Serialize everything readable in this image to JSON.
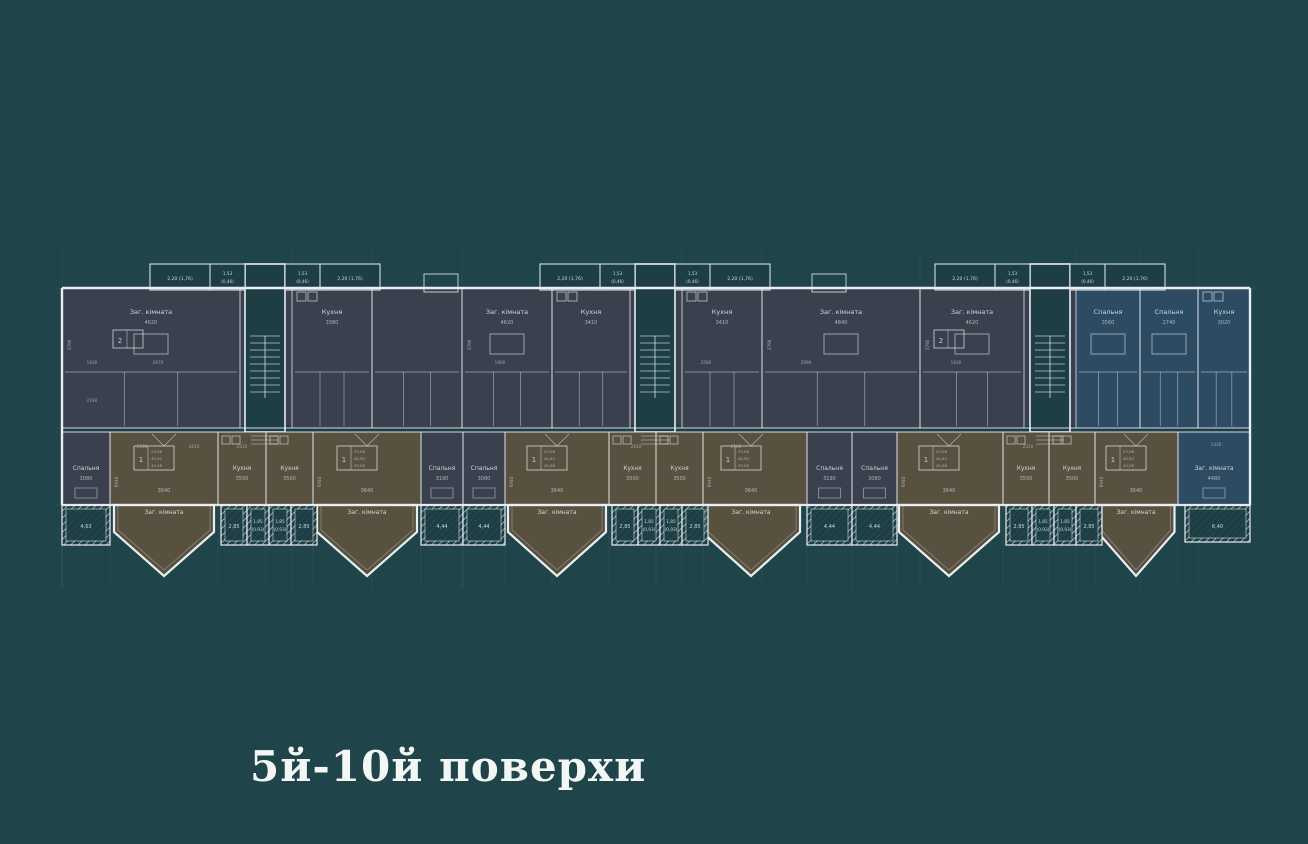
{
  "title": "5й-10й поверхи",
  "colors": {
    "background": "#1f4449",
    "room_dark": "#3a404d",
    "room_brown": "#595140",
    "room_blue": "#2d4b63",
    "core_fill": "#1c3e44",
    "wall": "#e9eef1",
    "label": "#ccd6da",
    "dim": "#a9b6bd",
    "title_color": "#f2f6f5"
  },
  "plan": {
    "balcony_top_large": "2,20 (1,76)",
    "balcony_top_small": "1,53 (0,46)",
    "cores": [
      {
        "cx": 265
      },
      {
        "cx": 655
      },
      {
        "cx": 1050
      }
    ],
    "upper_rooms": [
      {
        "x": 62,
        "w": 178,
        "label": "Заг. кімната",
        "dim": "4620",
        "fill": "dark",
        "badge": "2",
        "vdim": "3790"
      },
      {
        "x": 292,
        "w": 80,
        "label": "Кухня",
        "dim": "3380",
        "fill": "dark"
      },
      {
        "x": 372,
        "w": 90,
        "label": "",
        "dim": "",
        "fill": "dark"
      },
      {
        "x": 462,
        "w": 90,
        "label": "Заг. кімната",
        "dim": "4620",
        "fill": "dark",
        "vdim": "3790"
      },
      {
        "x": 552,
        "w": 78,
        "label": "Кухня",
        "dim": "3410",
        "fill": "dark"
      },
      {
        "x": 682,
        "w": 80,
        "label": "Кухня",
        "dim": "3410",
        "fill": "dark"
      },
      {
        "x": 762,
        "w": 158,
        "label": "Заг. кімната",
        "dim": "4840",
        "fill": "dark",
        "vdim": "3790"
      },
      {
        "x": 920,
        "w": 104,
        "label": "Заг. кімната",
        "dim": "4620",
        "fill": "dark",
        "badge": "2",
        "vdim": "3790"
      },
      {
        "x": 1076,
        "w": 64,
        "label": "Спальня",
        "dim": "3560",
        "fill": "blue"
      },
      {
        "x": 1140,
        "w": 58,
        "label": "Спальня",
        "dim": "2740",
        "fill": "blue"
      },
      {
        "x": 1198,
        "w": 52,
        "label": "Кухня",
        "dim": "3020",
        "fill": "blue"
      }
    ],
    "lower_rooms": [
      {
        "type": "spalnya",
        "x": 62,
        "w": 48,
        "label": "Спальня",
        "dim": "3080"
      },
      {
        "type": "living",
        "x": 110,
        "w": 108,
        "bay": 164,
        "label": "Заг. кімната",
        "dim": "3640",
        "vdim": "6940"
      },
      {
        "type": "kitchen",
        "x": 218,
        "w": 48,
        "label": "Кухня",
        "dim": "3500"
      },
      {
        "type": "kitchen",
        "x": 266,
        "w": 47,
        "label": "Кухня",
        "dim": "3500"
      },
      {
        "type": "living",
        "x": 313,
        "w": 108,
        "bay": 367,
        "label": "Заг. кімната",
        "dim": "3640",
        "vdim": "6940"
      },
      {
        "type": "spalnya",
        "x": 421,
        "w": 42,
        "label": "Спальня",
        "dim": "3190"
      },
      {
        "type": "spalnya",
        "x": 463,
        "w": 42,
        "label": "Спальня",
        "dim": "3080"
      },
      {
        "type": "living",
        "x": 505,
        "w": 104,
        "bay": 557,
        "label": "Заг. кімната",
        "dim": "3640",
        "vdim": "6940"
      },
      {
        "type": "kitchen",
        "x": 609,
        "w": 47,
        "label": "Кухня",
        "dim": "3500"
      },
      {
        "type": "kitchen",
        "x": 656,
        "w": 47,
        "label": "Кухня",
        "dim": "3500"
      },
      {
        "type": "living",
        "x": 703,
        "w": 104,
        "bay": 751,
        "label": "Заг. кімната",
        "dim": "3640",
        "vdim": "6940"
      },
      {
        "type": "spalnya",
        "x": 807,
        "w": 45,
        "label": "Спальня",
        "dim": "3190"
      },
      {
        "type": "spalnya",
        "x": 852,
        "w": 45,
        "label": "Спальня",
        "dim": "3080"
      },
      {
        "type": "living",
        "x": 897,
        "w": 106,
        "bay": 949,
        "label": "Заг. кімната",
        "dim": "3640",
        "vdim": "6940"
      },
      {
        "type": "kitchen",
        "x": 1003,
        "w": 46,
        "label": "Кухня",
        "dim": "3500"
      },
      {
        "type": "kitchen",
        "x": 1049,
        "w": 46,
        "label": "Кухня",
        "dim": "3500"
      },
      {
        "type": "living",
        "x": 1095,
        "w": 83,
        "bay": 1136,
        "label": "Заг. кімната",
        "dim": "3640",
        "vdim": "6940"
      },
      {
        "type": "blue_living",
        "x": 1178,
        "w": 72,
        "label": "Заг. кімната",
        "dim": "4480"
      }
    ],
    "badge1": {
      "num": "1",
      "values": [
        "23,06",
        "40,50",
        "43,28"
      ]
    },
    "badge2": {
      "num": "2",
      "values": []
    },
    "bottom_balconies": [
      {
        "x": 62,
        "w": 48,
        "label": "4,63"
      },
      {
        "x": 221,
        "w": 26,
        "label": "2,85"
      },
      {
        "x": 247,
        "w": 22,
        "label": "1,85 (0,93)"
      },
      {
        "x": 269,
        "w": 22,
        "label": "1,85 (0,93)"
      },
      {
        "x": 291,
        "w": 26,
        "label": "2,85"
      },
      {
        "x": 421,
        "w": 42,
        "label": "4,44"
      },
      {
        "x": 463,
        "w": 42,
        "label": "4,44"
      },
      {
        "x": 612,
        "w": 26,
        "label": "2,85"
      },
      {
        "x": 638,
        "w": 22,
        "label": "1,85 (0,93)"
      },
      {
        "x": 660,
        "w": 22,
        "label": "1,85 (0,93)"
      },
      {
        "x": 682,
        "w": 26,
        "label": "2,85"
      },
      {
        "x": 807,
        "w": 45,
        "label": "4,44"
      },
      {
        "x": 852,
        "w": 45,
        "label": "4,44"
      },
      {
        "x": 1006,
        "w": 26,
        "label": "2,85"
      },
      {
        "x": 1032,
        "w": 22,
        "label": "1,85 (0,93)"
      },
      {
        "x": 1054,
        "w": 22,
        "label": "1,85 (0,93)"
      },
      {
        "x": 1076,
        "w": 26,
        "label": "2,85"
      },
      {
        "x": 1185,
        "w": 65,
        "label": "6,40",
        "blue": true
      }
    ],
    "extra_dims": [
      {
        "t": "1930",
        "x": 92,
        "y": 364
      },
      {
        "t": "2670",
        "x": 158,
        "y": 364
      },
      {
        "t": "2190",
        "x": 92,
        "y": 402
      },
      {
        "t": "1900",
        "x": 500,
        "y": 364
      },
      {
        "t": "2580",
        "x": 706,
        "y": 364
      },
      {
        "t": "1930",
        "x": 956,
        "y": 364
      },
      {
        "t": "2990",
        "x": 806,
        "y": 364
      },
      {
        "t": "2100",
        "x": 142,
        "y": 448
      },
      {
        "t": "2610",
        "x": 194,
        "y": 448
      },
      {
        "t": "2310",
        "x": 242,
        "y": 448
      },
      {
        "t": "2610",
        "x": 636,
        "y": 448
      },
      {
        "t": "2100",
        "x": 736,
        "y": 448
      },
      {
        "t": "2310",
        "x": 1028,
        "y": 448
      },
      {
        "t": "1430",
        "x": 1216,
        "y": 446
      }
    ]
  }
}
